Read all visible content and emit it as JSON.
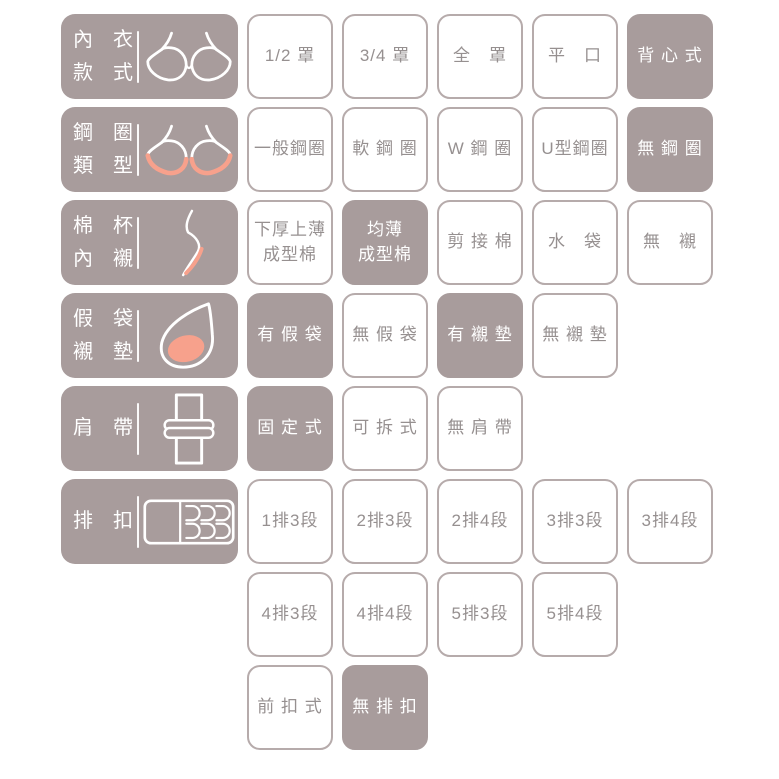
{
  "colors": {
    "taupe": "#a89c9c",
    "salmon": "#f7a18c",
    "cell_border": "#b6abab",
    "option_text": "#969090",
    "selected_text": "#ffffff",
    "background": "#ffffff"
  },
  "rows": [
    {
      "category": "內　衣\n款　式",
      "icon": "bra-outline-icon",
      "options": [
        {
          "text": "1/2 罩",
          "selected": false
        },
        {
          "text": "3/4 罩",
          "selected": false
        },
        {
          "text": "全　罩",
          "selected": false
        },
        {
          "text": "平　口",
          "selected": false
        },
        {
          "text": "背 心 式",
          "selected": true
        }
      ]
    },
    {
      "category": "鋼　圈\n類　型",
      "icon": "bra-underwire-icon",
      "options": [
        {
          "text": "一般鋼圈",
          "selected": false
        },
        {
          "text": "軟 鋼 圈",
          "selected": false
        },
        {
          "text": "W 鋼 圈",
          "selected": false
        },
        {
          "text": "U型鋼圈",
          "selected": false
        },
        {
          "text": "無 鋼 圈",
          "selected": true
        }
      ]
    },
    {
      "category": "棉　杯\n內　襯",
      "icon": "cup-profile-icon",
      "options": [
        {
          "text": "下厚上薄\n成型棉",
          "selected": false
        },
        {
          "text": "均薄\n成型棉",
          "selected": true
        },
        {
          "text": "剪 接 棉",
          "selected": false
        },
        {
          "text": "水　袋",
          "selected": false
        },
        {
          "text": "無　襯",
          "selected": false
        }
      ]
    },
    {
      "category": "假　袋\n襯　墊",
      "icon": "pad-icon",
      "options": [
        {
          "text": "有 假 袋",
          "selected": true
        },
        {
          "text": "無 假 袋",
          "selected": false
        },
        {
          "text": "有 襯 墊",
          "selected": true
        },
        {
          "text": "無 襯 墊",
          "selected": false
        }
      ]
    },
    {
      "category": "肩　帶",
      "icon": "strap-icon",
      "options": [
        {
          "text": "固 定 式",
          "selected": true
        },
        {
          "text": "可 拆 式",
          "selected": false
        },
        {
          "text": "無 肩 帶",
          "selected": false
        }
      ]
    },
    {
      "category": "排　扣",
      "icon": "hook-closure-icon",
      "options": [
        {
          "text": "1排3段",
          "selected": false
        },
        {
          "text": "2排3段",
          "selected": false
        },
        {
          "text": "2排4段",
          "selected": false
        },
        {
          "text": "3排3段",
          "selected": false
        },
        {
          "text": "3排4段",
          "selected": false
        }
      ]
    },
    {
      "category": "",
      "icon": "",
      "options": [
        {
          "text": "4排3段",
          "selected": false
        },
        {
          "text": "4排4段",
          "selected": false
        },
        {
          "text": "5排3段",
          "selected": false
        },
        {
          "text": "5排4段",
          "selected": false
        }
      ]
    },
    {
      "category": "",
      "icon": "",
      "options": [
        {
          "text": "前 扣 式",
          "selected": false
        },
        {
          "text": "無 排 扣",
          "selected": true
        }
      ]
    }
  ]
}
